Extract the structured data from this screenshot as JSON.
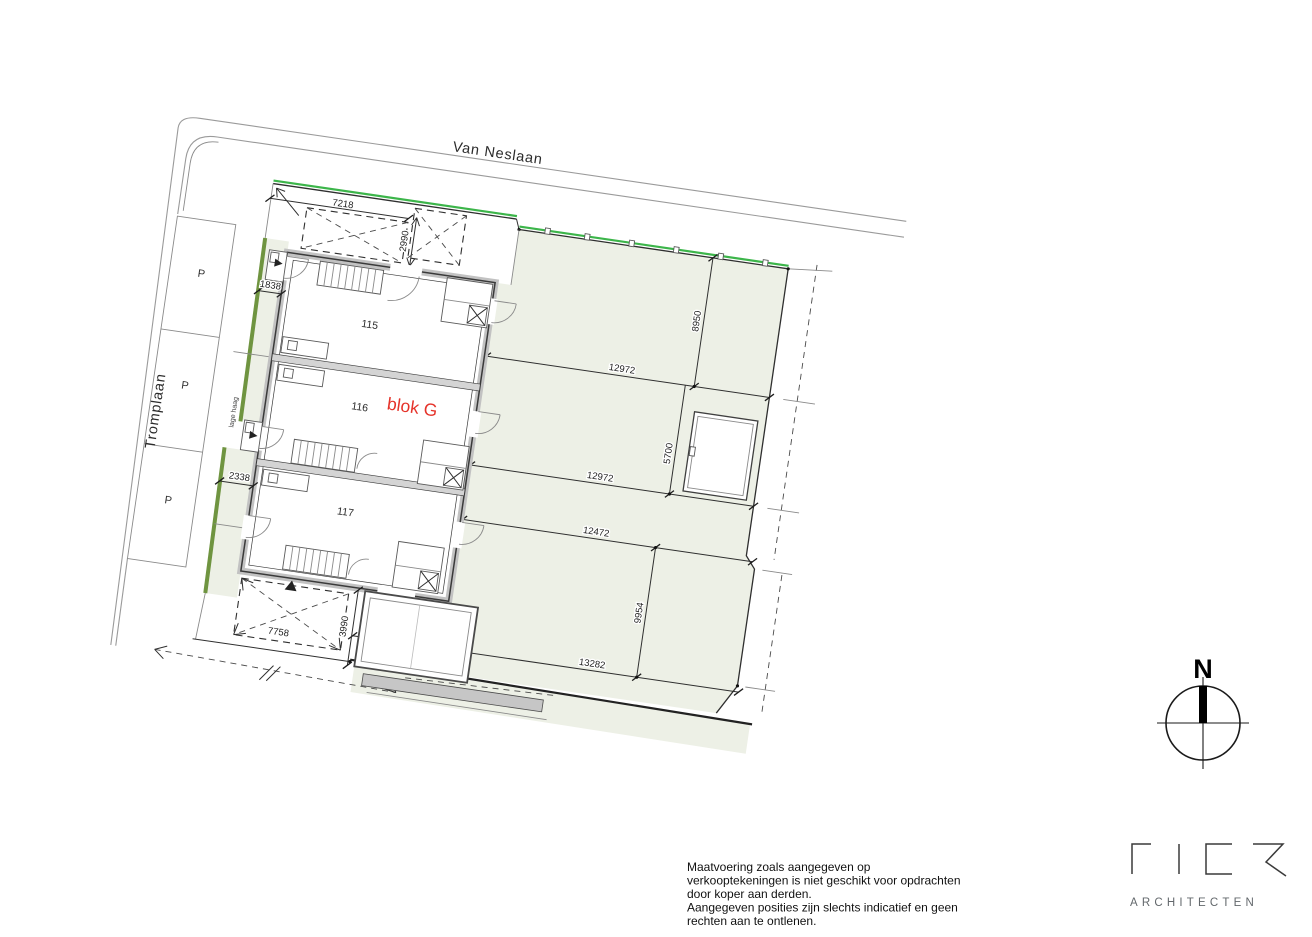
{
  "streets": {
    "van_neslaan": "Van Neslaan",
    "tromplaan": "Tromplaan"
  },
  "site": {
    "block_label": "blok G",
    "units": [
      "115",
      "116",
      "117"
    ],
    "parking_label": "P",
    "hedge_label": "lage haag"
  },
  "dimensions": {
    "top_parking_width": "7218",
    "top_parking_depth": "2990",
    "front_path_width_north": "1838",
    "front_path_width_south": "2338",
    "garden_115_width": "12972",
    "garden_115_depth": "8950",
    "garden_116_width": "12972",
    "garden_116_depth": "5700",
    "garden_117_width": "12472",
    "garden_117_depth": "9954",
    "garden_117_south_width": "13282",
    "south_parking_width": "7758",
    "rear_extension_depth": "3990"
  },
  "compass": {
    "north_label": "N"
  },
  "branding": {
    "firm": "FIER",
    "subtitle": "ARCHITECTEN"
  },
  "disclaimer": {
    "lines": [
      "Maatvoering zoals aangegeven op",
      "verkooptekeningen is niet geschikt voor opdrachten",
      "door koper aan derden.",
      "Aangegeven posities zijn slechts indicatief en geen",
      "rechten aan te ontlenen."
    ]
  },
  "colors": {
    "parcel_fill": "#edf0e6",
    "fence_green": "#3cb54a",
    "hedge_green": "#6f9440",
    "accent_red": "#e5332a",
    "wall_gray": "#c2c2c2"
  }
}
